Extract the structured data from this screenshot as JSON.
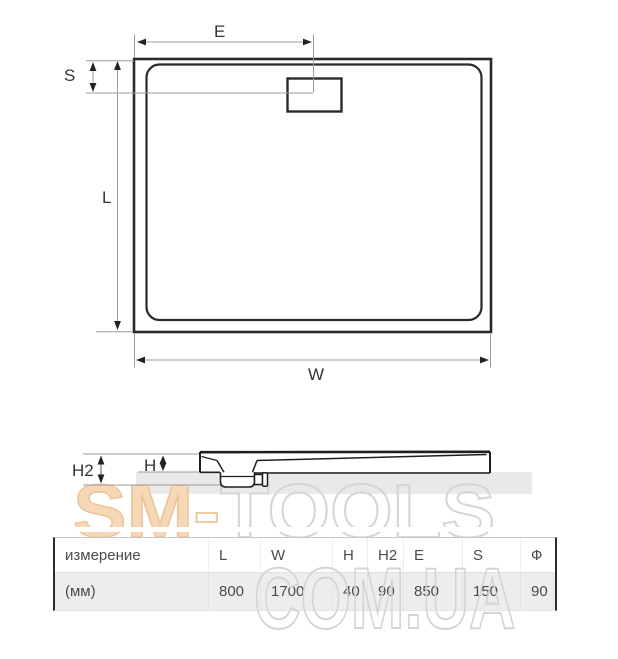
{
  "top_view": {
    "label_e": "E",
    "label_s": "S",
    "label_l": "L",
    "label_w": "W"
  },
  "side_view": {
    "label_h2": "H2",
    "label_h": "H"
  },
  "watermark": {
    "text_sm": "SM",
    "text_hyphen": "-",
    "text_tools": "TOOLS",
    "text_line2": "COM.UA",
    "peach_color": "#f7d8b6",
    "outline_gray_color": "#d6d6d6"
  },
  "colors": {
    "drawing_line": "#2a2a2a",
    "dimension_line": "#9b9b9b",
    "table_row_bg": "#ededed",
    "table_text": "#4b4b4b"
  },
  "table": {
    "headers": [
      "измерение",
      "L",
      "W",
      "H",
      "H2",
      "E",
      "S",
      "Ф"
    ],
    "row": [
      "(мм)",
      "800",
      "1700",
      "40",
      "90",
      "850",
      "150",
      "90"
    ]
  }
}
